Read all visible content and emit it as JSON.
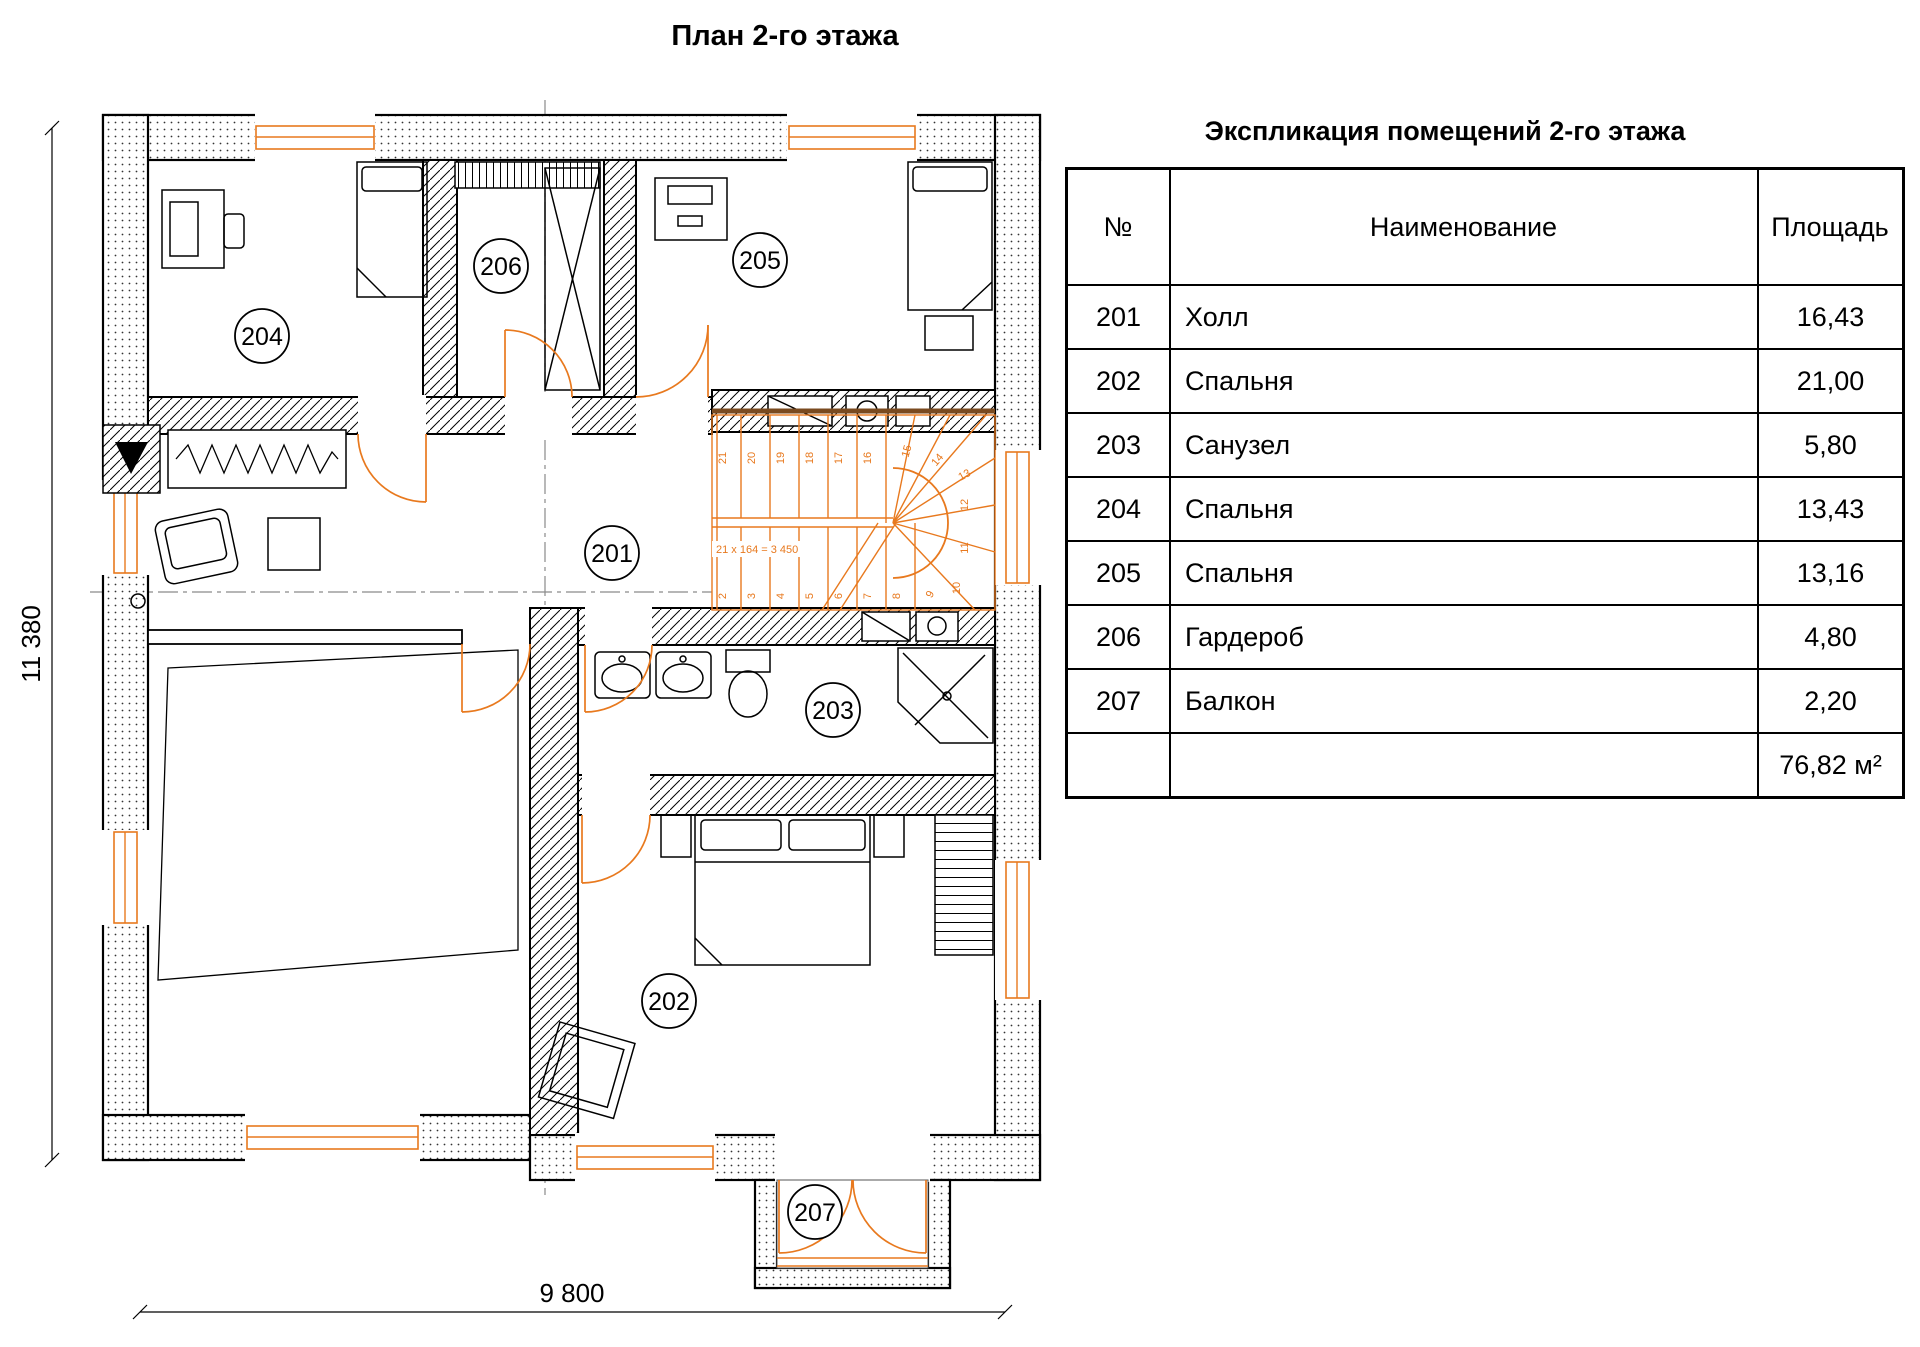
{
  "page_title": "План 2-го этажа",
  "plan": {
    "room_labels": [
      "201",
      "202",
      "203",
      "204",
      "205",
      "206",
      "207"
    ],
    "dimensions": {
      "height_label": "11 380",
      "width_label": "9 800"
    },
    "stairs": {
      "note": "21 x 164 = 3 450",
      "top_steps": [
        "21",
        "20",
        "19",
        "18",
        "17",
        "16"
      ],
      "turn_steps": [
        "15",
        "14",
        "13",
        "12",
        "11",
        "10",
        "9"
      ],
      "bottom_steps": [
        "2",
        "3",
        "4",
        "5",
        "6",
        "7",
        "8"
      ]
    },
    "colors": {
      "accent_orange": "#E8791E",
      "wall_black": "#000000",
      "stair_brown": "#7a4a1f"
    }
  },
  "table": {
    "title": "Экспликация помещений 2-го этажа",
    "headers": {
      "no": "№",
      "name": "Наименование",
      "area": "Площадь"
    },
    "rows": [
      {
        "no": "201",
        "name": "Холл",
        "area": "16,43"
      },
      {
        "no": "202",
        "name": "Спальня",
        "area": "21,00"
      },
      {
        "no": "203",
        "name": "Санузел",
        "area": "5,80"
      },
      {
        "no": "204",
        "name": "Спальня",
        "area": "13,43"
      },
      {
        "no": "205",
        "name": "Спальня",
        "area": "13,16"
      },
      {
        "no": "206",
        "name": "Гардероб",
        "area": "4,80"
      },
      {
        "no": "207",
        "name": "Балкон",
        "area": "2,20"
      }
    ],
    "total_area": "76,82 м²"
  }
}
